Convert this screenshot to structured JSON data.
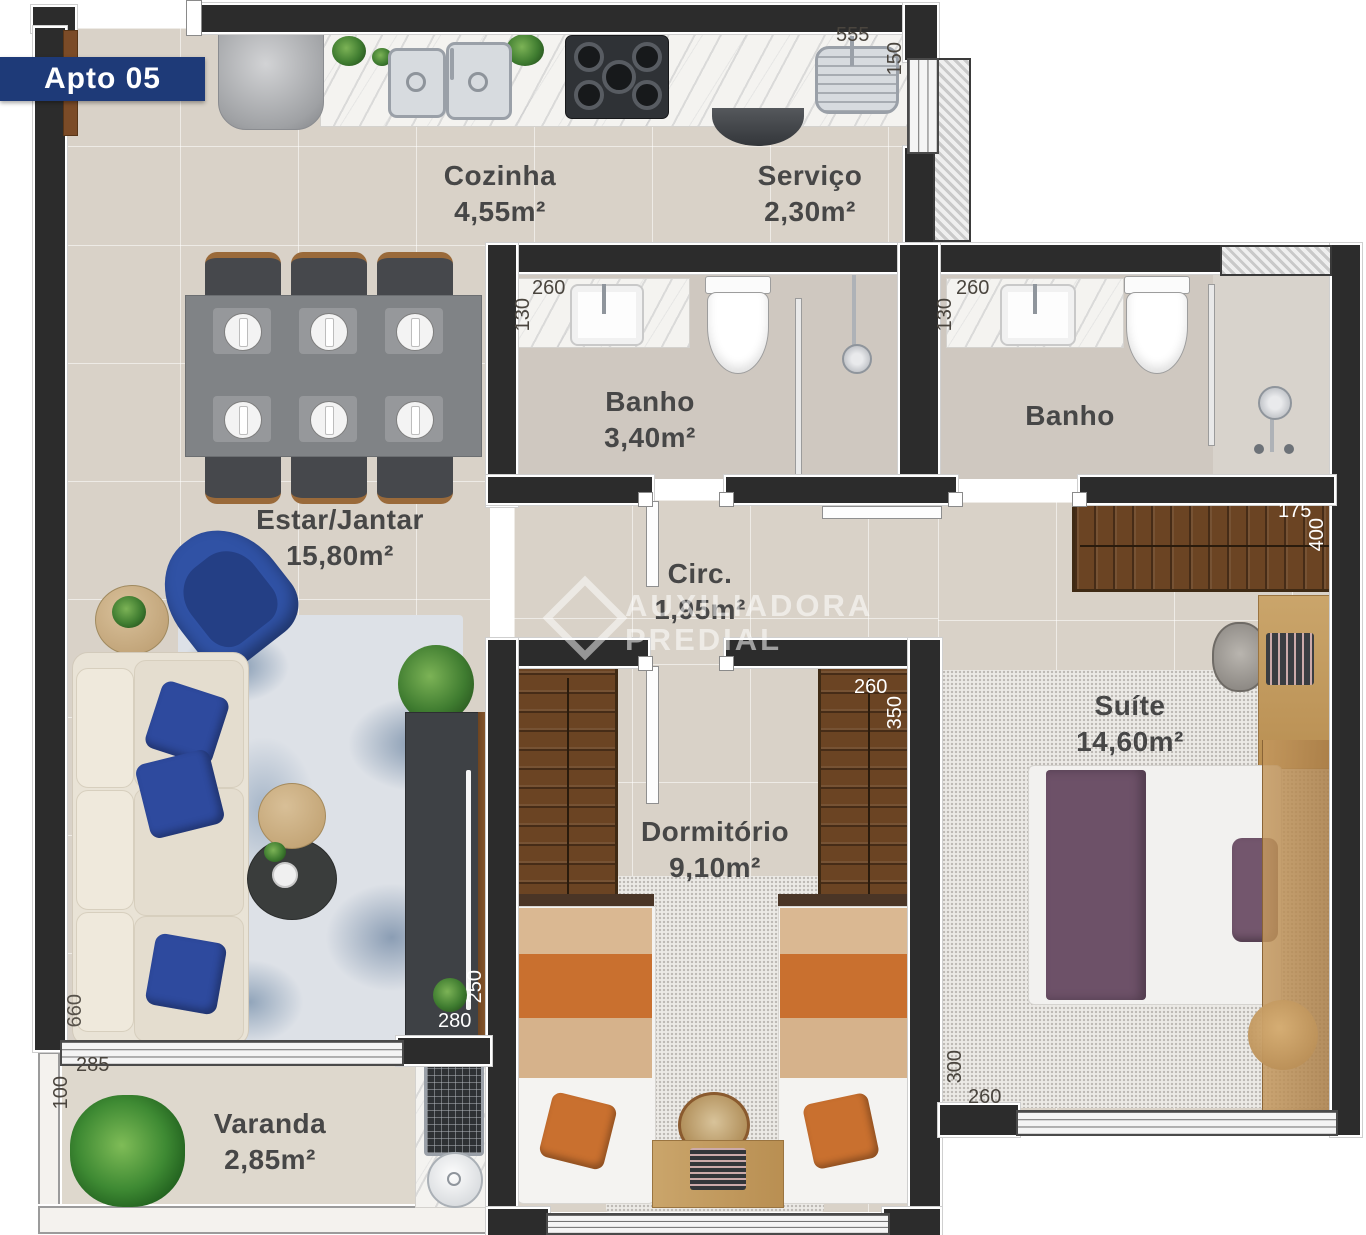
{
  "banner": {
    "label": "Apto 05"
  },
  "watermark": {
    "line1": "AUXILIADORA",
    "line2": "PREDIAL"
  },
  "rooms": {
    "cozinha": {
      "name": "Cozinha",
      "area": "4,55m²"
    },
    "servico": {
      "name": "Serviço",
      "area": "2,30m²"
    },
    "banho1": {
      "name": "Banho",
      "area": "3,40m²"
    },
    "banho2": {
      "name": "Banho"
    },
    "estar": {
      "name": "Estar/Jantar",
      "area": "15,80m²"
    },
    "circ": {
      "name": "Circ.",
      "area": "1,95m²"
    },
    "dormitorio": {
      "name": "Dormitório",
      "area": "9,10m²"
    },
    "suite": {
      "name": "Suíte",
      "area": "14,60m²"
    },
    "varanda": {
      "name": "Varanda",
      "area": "2,85m²"
    }
  },
  "dims": {
    "servico_tanque": {
      "w": "555",
      "h": "150"
    },
    "banho1_vanity": {
      "w": "260",
      "h": "130"
    },
    "banho2_vanity": {
      "w": "260",
      "h": "130"
    },
    "dorm_wardrobe": {
      "w": "260",
      "h": "350"
    },
    "suite_wardrobe": {
      "w": "175",
      "h": "400"
    },
    "tv_console": {
      "w": "280",
      "h": "250"
    },
    "sofa": {
      "l": "660"
    },
    "varanda": {
      "w": "285",
      "h": "100"
    },
    "suite_bed": {
      "w": "260",
      "h": "300"
    }
  },
  "colors": {
    "banner_bg": "#1e3a78",
    "wall": "#2c2c2c",
    "floor": "#d9d2c8",
    "accent_blue": "#2e4a9e",
    "bed_orange": "#c9702f",
    "bed_purple": "#6d5168",
    "wood": "#7a4e26"
  }
}
